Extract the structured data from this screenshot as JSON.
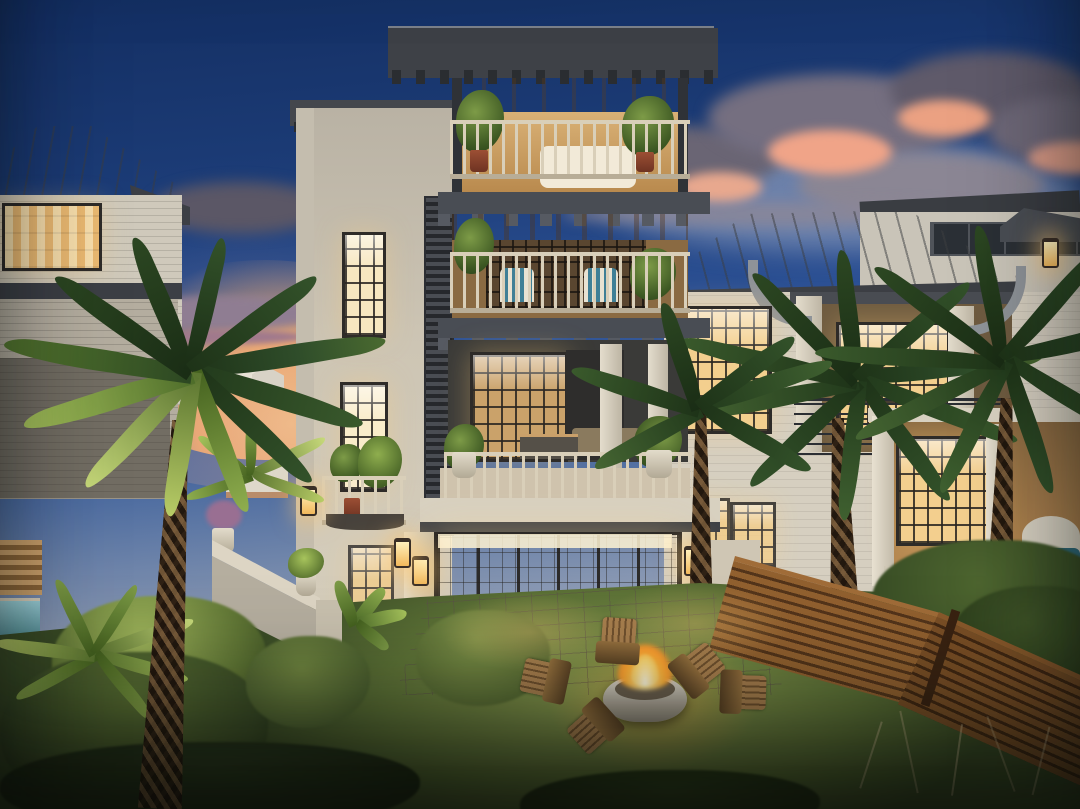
{
  "scene": {
    "type": "architectural-rendering",
    "time_of_day": "dusk",
    "setting": "coastal residential backyard",
    "description": "Four-story coastal luxury home at twilight with stacked lit balconies, glass-walled ground floor revealing an indoor pool, flanked by two neighboring beach houses, palm trees, backyard lawn with round fire bowl and Adirondack chairs, and a diagonal horizontal-slat wood fence."
  },
  "palette": {
    "sky-top": "#142f63",
    "sky-horizon": "#cfc5c2",
    "sunset": "#f6c285",
    "cloud-dark": "#6a6574",
    "cloud-pink": "#f0a488",
    "wall-cream": "#d9d2c1",
    "wall-shadow": "#b9b2a6",
    "roof-dark": "#3e4147",
    "roof-metal": "#9aa0a2",
    "window-warm": "#f3cf8e",
    "wood-ceiling": "#d9b279",
    "rail-cream": "#d9cfb9",
    "louver-dark": "#3a3d42",
    "palm-dark": "#2c4a24",
    "palm-lit": "#a7c45c",
    "trunk-brown": "#4a3826",
    "lawn-lit": "#8ea052",
    "lawn-dark": "#3a4c26",
    "paver": "#b7afa0",
    "fence-wood": "#8a5a30",
    "fire-orange": "#ff9b2e",
    "pool-blue": "#9fcfe0"
  },
  "objects": {
    "main_house": {
      "stories": 4,
      "features": [
        "covered top balcony with wood ceiling",
        "third-floor balcony with striped chairs",
        "large open terrace with lounge seating",
        "glass-walled ground floor with indoor pool",
        "lantern sconces",
        "louvered shutter column",
        "potted plants on every level"
      ]
    },
    "left_house": {
      "features": [
        "standing-seam metal hip roof",
        "lit corner window with curtains",
        "lap siding"
      ]
    },
    "right_house": {
      "features": [
        "hip metal roof",
        "covered upper balcony with cable railing",
        "curved knee braces",
        "lit porch with glass doors",
        "spa"
      ]
    },
    "background": [
      "distant white cottages at sunset horizon",
      "pink-lit cumulus clouds"
    ],
    "backyard": {
      "fire_bowl": "round white concrete bowl with burning fire",
      "adirondack_chairs": 5,
      "lawn": true,
      "paver_patio": true,
      "wood_slat_fence": true,
      "garden_wall": true,
      "pool_left_edge": true
    },
    "palm_trees": 4
  }
}
